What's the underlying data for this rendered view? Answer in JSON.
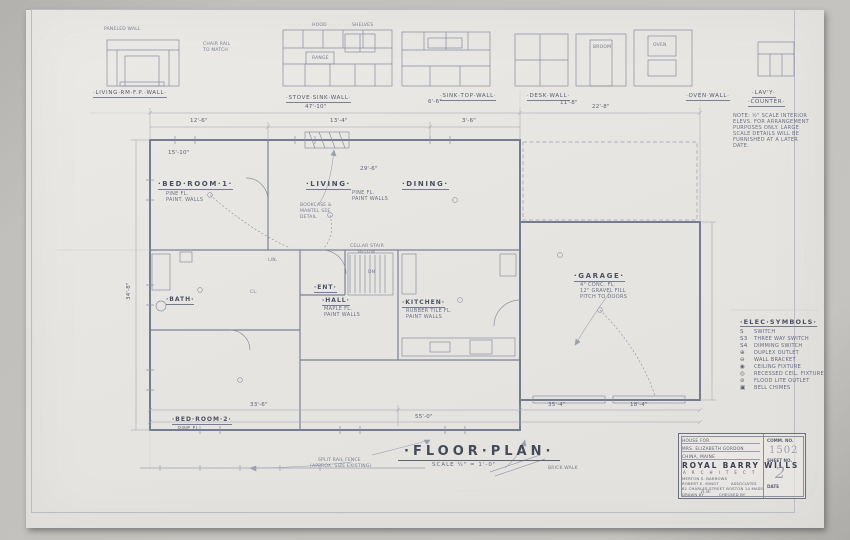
{
  "elevations": {
    "labels": {
      "living_fp": "·LIVING·RM·F.P.·WALL·",
      "stove_sink": "·STOVE·SINK·WALL·",
      "sink_top": "·SINK·TOP·WALL·",
      "desk": "·DESK·WALL·",
      "oven": "·OVEN·WALL·",
      "lavy1": "·LAV'Y·",
      "lavy2": "·COUNTER·"
    },
    "annotations": {
      "paneled_wall": "PANELED WALL",
      "chair_rail": "CHAIR RAIL",
      "to_match": "TO MATCH",
      "hood": "HOOD",
      "shelves": "SHELVES",
      "range": "RANGE",
      "broom": "BROOM",
      "oven": "OVEN"
    },
    "dims": {
      "d1": "6'-6\"",
      "d2": "11'-8\""
    }
  },
  "note": {
    "l1": "NOTE: ½\" SCALE INTERIOR",
    "l2": "ELEVS. FOR ARRANGEMENT",
    "l3": "PURPOSES ONLY. LARGE",
    "l4": "SCALE DETAILS WILL BE",
    "l5": "FURNISHED AT A LATER",
    "l6": "DATE."
  },
  "plan": {
    "rooms": {
      "bedroom1": {
        "name": "·BED·ROOM·1·",
        "n1": "PINE FL.",
        "n2": "PAINT. WALLS"
      },
      "living": {
        "name": "·LIVING·"
      },
      "dining": {
        "name": "·DINING·"
      },
      "living_n1": "PINE FL.",
      "living_n2": "PAINT WALLS",
      "ent": "·ENT·",
      "hall": {
        "name": "·HALL·",
        "n1": "MAPLE FL.",
        "n2": "PAINT WALLS"
      },
      "kitchen": {
        "name": "·KITCHEN·",
        "n1": "RUBBER TILE FL.",
        "n2": "PAINT WALLS"
      },
      "garage": {
        "name": "·GARAGE·",
        "n1": "4\" CONC. FL.",
        "n2": "12\" GRAVEL FILL",
        "n3": "PITCH TO DOORS"
      },
      "bedroom2": {
        "name": "·BED·ROOM·2·",
        "n1": "PINE FL.",
        "n2": "PAINT. WALLS"
      },
      "bath": "·BATH·"
    },
    "dims": {
      "overall_top": "47'-10\"",
      "t1": "12'-6\"",
      "t2": "13'-4\"",
      "t3": "3'-6\"",
      "bd1": "15'-10\"",
      "ld": "29'-6\"",
      "garage_top": "22'-8\"",
      "left": "34'-8\"",
      "b1": "33'-6\"",
      "b2": "35'-4\"",
      "b3": "18'-4\"",
      "overall_bottom": "55'-0\""
    },
    "annotations": {
      "bookcase1": "BOOKCASE &",
      "bookcase2": "MANTEL SEE",
      "bookcase3": "DETAIL",
      "cellar1": "CELLAR STAIR",
      "cellar2": "BELOW",
      "dn": "DN",
      "lin": "LIN.",
      "cl": "CL.",
      "fence1": "SPLIT RAIL FENCE",
      "fence2": "(APPROX. SIZE EXISTING)",
      "brick_walk": "BRICK WALK"
    }
  },
  "legend": {
    "title": "·ELEC·SYMBOLS·",
    "items": [
      {
        "sym": "S",
        "label": "SWITCH"
      },
      {
        "sym": "S3",
        "label": "THREE WAY SWITCH"
      },
      {
        "sym": "S4",
        "label": "DIMMING SWITCH"
      },
      {
        "sym": "⊕",
        "label": "DUPLEX OUTLET"
      },
      {
        "sym": "⊖",
        "label": "WALL BRACKET"
      },
      {
        "sym": "◉",
        "label": "CEILING FIXTURE"
      },
      {
        "sym": "◎",
        "label": "RECESSED CEIL. FIXTURE"
      },
      {
        "sym": "⊘",
        "label": "FLOOD LITE OUTLET"
      },
      {
        "sym": "▣",
        "label": "BELL CHIMES"
      }
    ]
  },
  "plan_title": {
    "text": "·FLOOR·PLAN·",
    "scale": "SCALE  ¼\" = 1'-0\""
  },
  "title_block": {
    "project_line1": "HOUSE FOR.",
    "project_line2": "MRS. ELIZABETH GORDON",
    "project_line3": "CHINA, MAINE",
    "comm_label": "COMM. NO.",
    "comm_no": "1502",
    "sheet_label": "SHEET NO.",
    "sheet_no": "2",
    "firm": "ROYAL BARRY WILLS",
    "firm_sub": "A R C H I T E C T",
    "assoc1": "MERTON S. BARROWS",
    "assoc2": "ROBERT E. MINOT",
    "assoc2b": "ASSOCIATES",
    "address": "81 CHARLES STREET BOSTON 14 MASS.",
    "drawn_label": "DRAWN BY",
    "drawn_by": "R.W.",
    "checked_label": "CHECKED BY",
    "date_label": "DATE"
  }
}
